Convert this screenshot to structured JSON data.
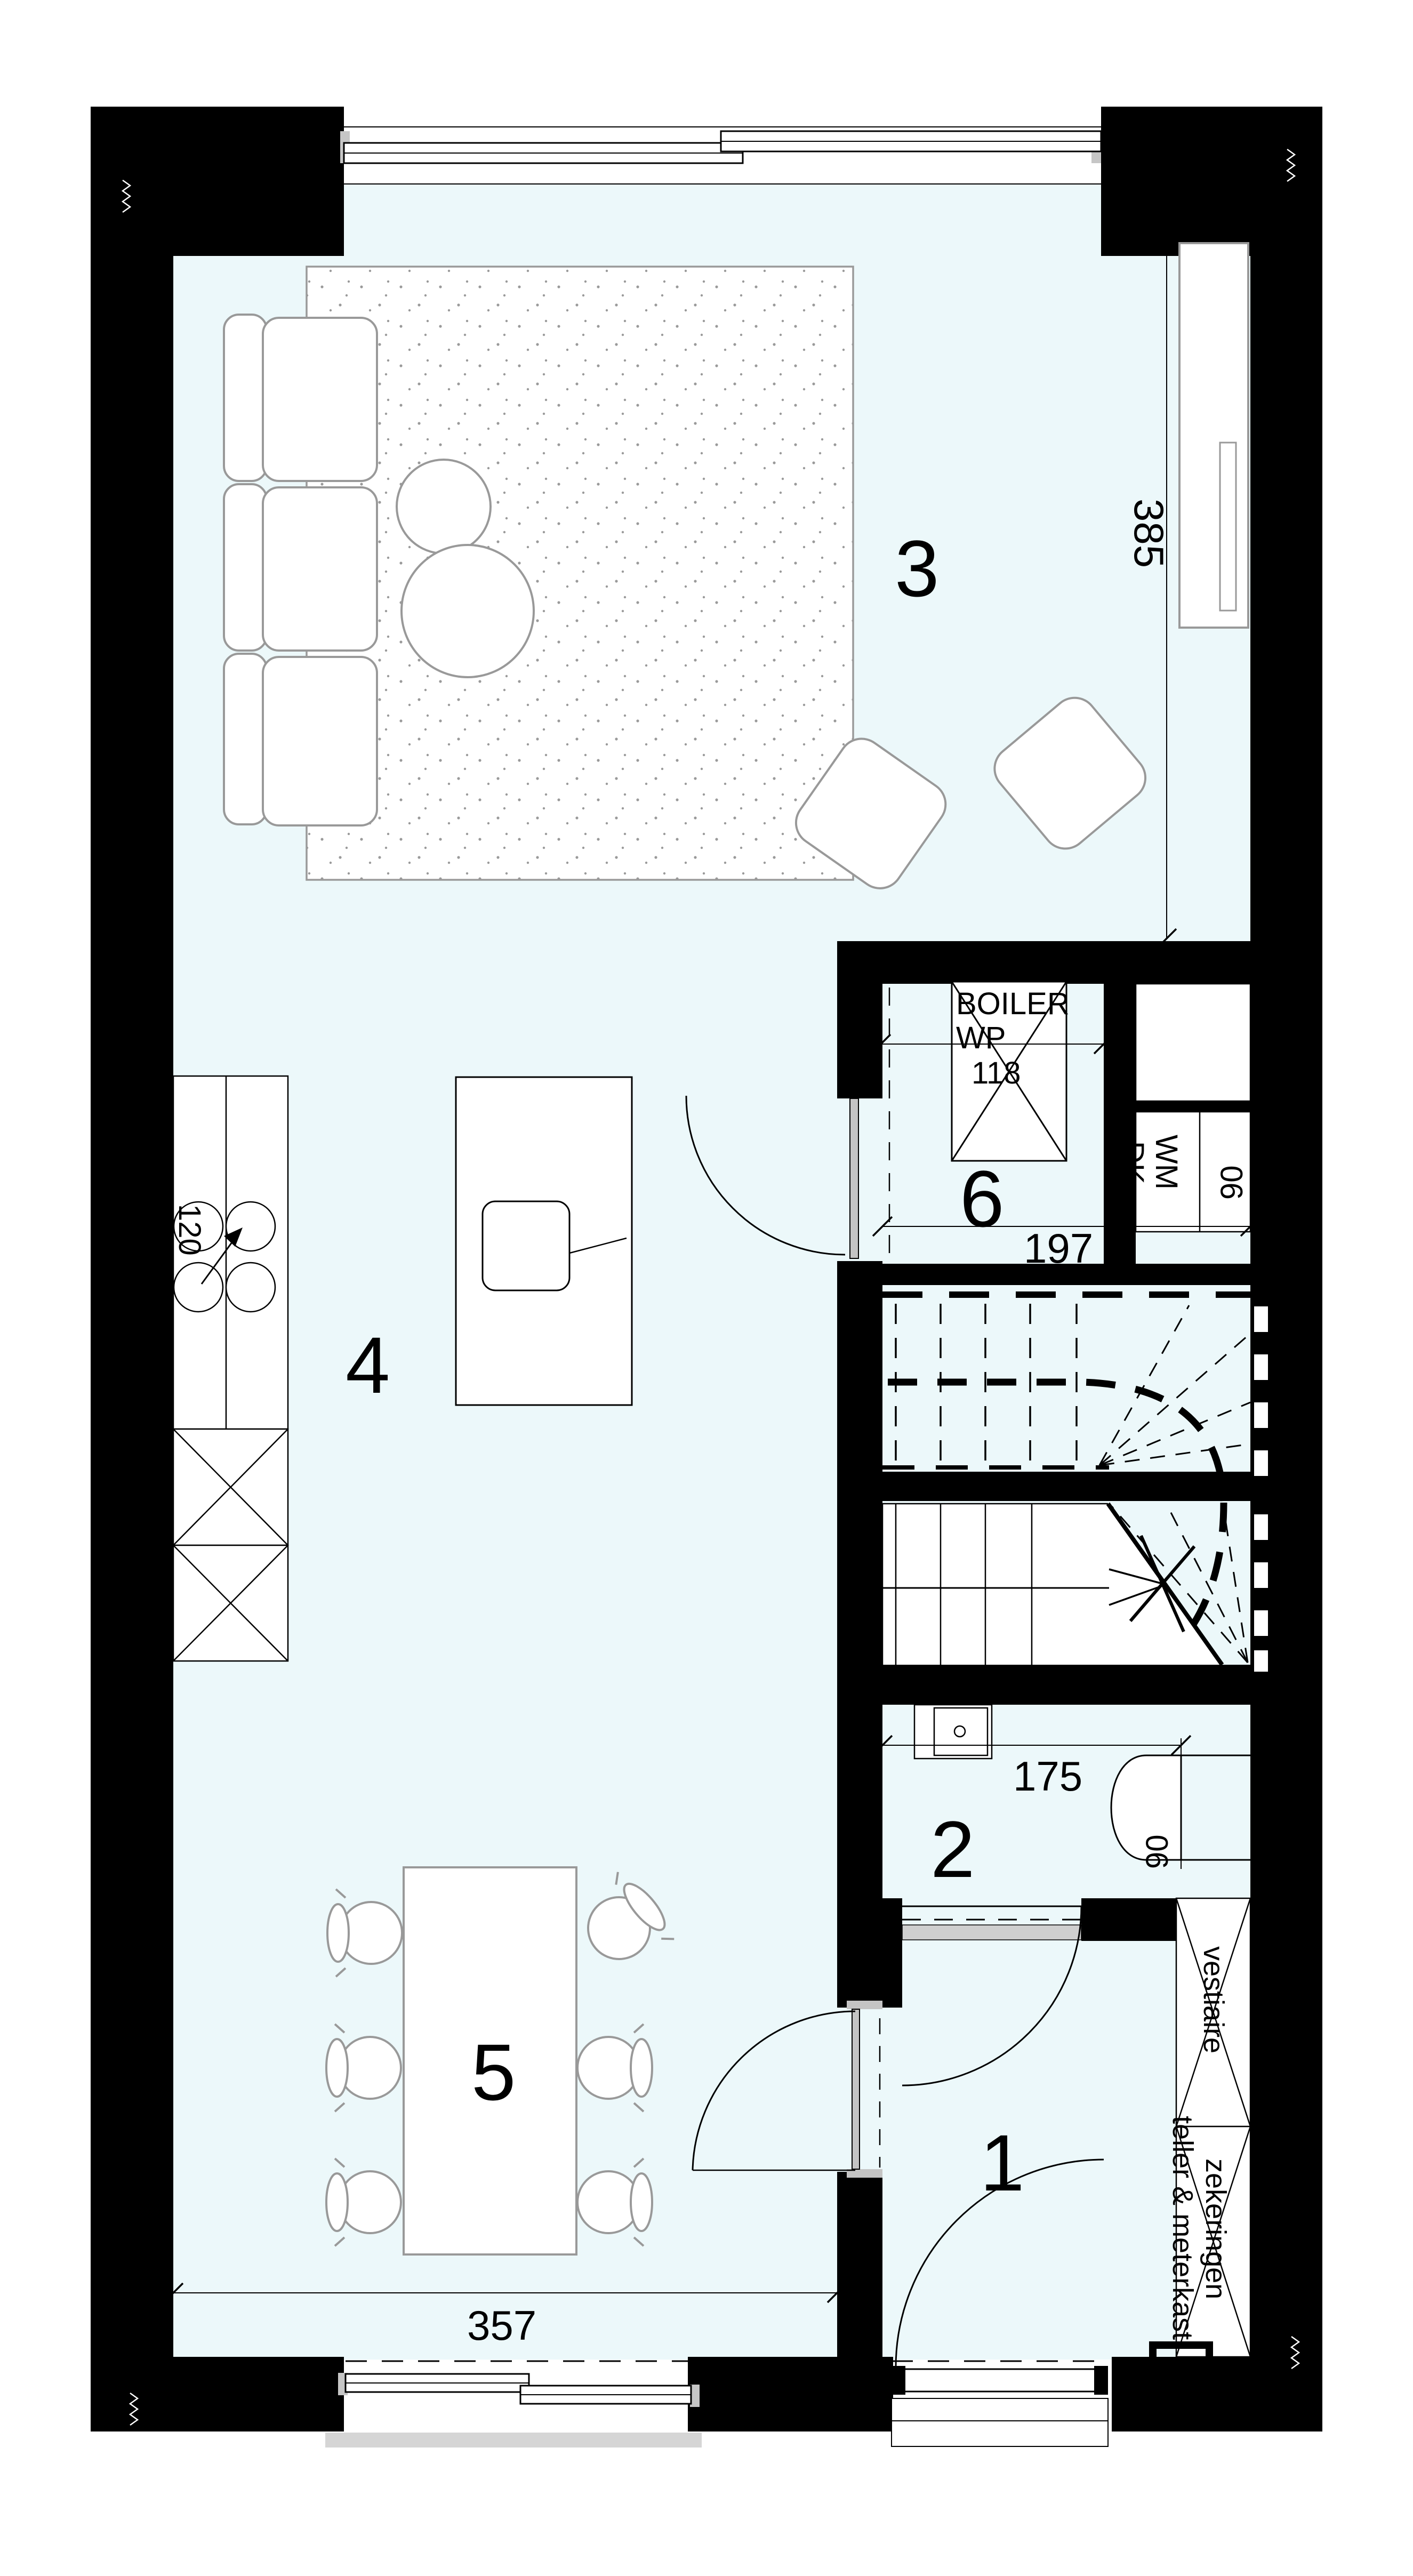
{
  "plan": {
    "rooms": {
      "living": "3",
      "kitchen": "4",
      "dining": "5",
      "utility": "6",
      "toilet": "2",
      "hall": "1"
    },
    "dims": {
      "cabinet_height": "385",
      "counter": "120",
      "utility_width": "197",
      "boiler_width": "118",
      "toilet_width": "175",
      "toilet_depth": "90",
      "appliance_width": "90",
      "living_width": "357"
    },
    "fixtures": {
      "boiler_line1": "BOILER",
      "boiler_line2": "WP",
      "dishwasher": "DK",
      "washing_machine": "WM",
      "wardrobe": "vestiaire",
      "meter_line1": "teller & meterkast",
      "meter_line2": "zekeringen"
    },
    "colors": {
      "floor": "#ecf8fa",
      "wall": "#000000",
      "furniture": "#999999",
      "sill": "#cccccc"
    }
  }
}
